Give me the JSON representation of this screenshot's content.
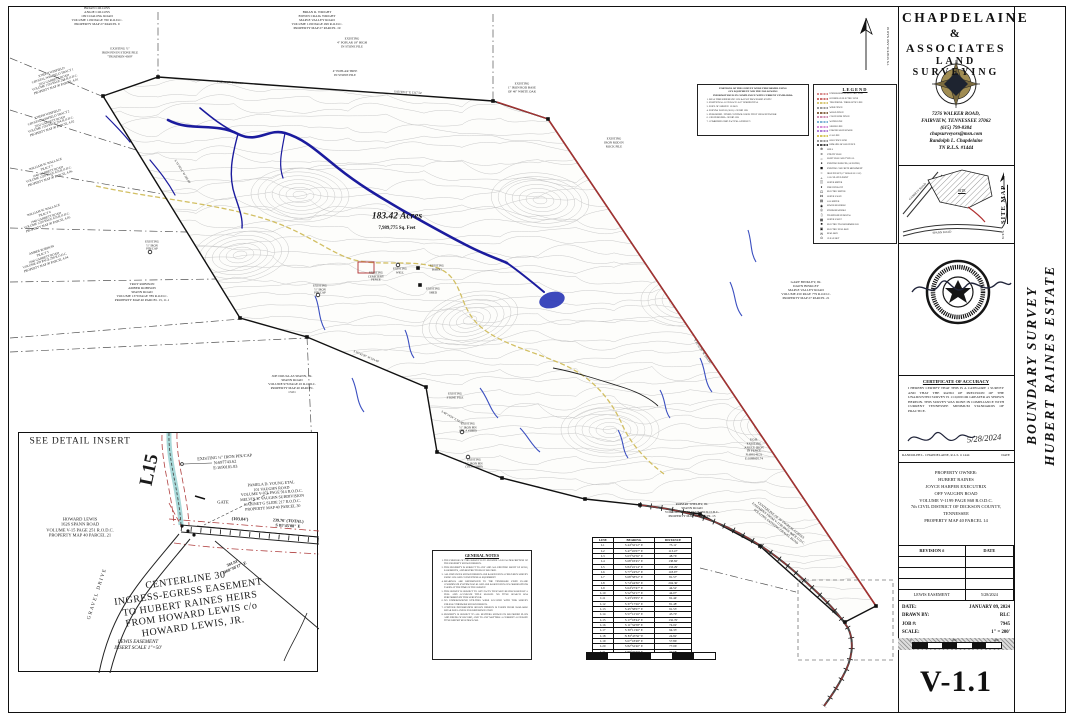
{
  "sheet": {
    "number": "V-1.1"
  },
  "title_block": {
    "line1": "CHAPDELAINE",
    "line2": "& ASSOCIATES",
    "line3": "LAND SURVEYING",
    "address1": "7276 WALKER ROAD,",
    "address2": "FAIRVIEW, TENNESSEE 37062",
    "phone": "(615) 799-8384",
    "email": "chapsurveyors@msn.com",
    "surveyor": "Randolph L. Chapdelaine",
    "license": "TN R.L.S. #1444"
  },
  "side_title": {
    "line1": "BOUNDARY SURVEY",
    "line2": "HUBERT RAINES ESTATE"
  },
  "site_map": {
    "label": "SITE MAP",
    "nts": "N.T.S.",
    "site": "SITE",
    "road1": "GARRETT ROAD",
    "road2": "SPANN ROAD"
  },
  "certificate": {
    "title": "CERTIFICATE OF ACCURACY",
    "body": "I HEREBY CERTIFY THAT THIS IS A CATEGORY 1 SURVEY AND THAT THE RATIO OF PRECISION OF THE UNADJUSTED SURVEY IS 1:10,000 OR GREATER AS SHOWN HEREON. THIS SURVEY WAS DONE IN COMPLIANCE WITH CURRENT TENNESSEE MINIMUM STANDARDS OF PRACTICE.",
    "sig_date": "5/28/2024",
    "signer": "RANDOLPH L. CHAPDELAINE, R.L.S. # 1444",
    "date_label": "DATE"
  },
  "owner_block": {
    "lines": [
      "PROPERTY OWNER:",
      "HUBERT RAINES",
      "JOYCE HARPER EXECUTRIX",
      "OFF VAUGHN ROAD",
      "VOLUME V-1199 PAGE 868 R.O.D.C.",
      "7th CIVIL DISTRICT OF DICKSON COUNTY,",
      "TENNESSEE",
      "PROPERTY MAP 40 PARCEL 14"
    ]
  },
  "revisions": {
    "header": {
      "rev": "REVISION #",
      "date": "DATE"
    },
    "rows": [
      [
        "",
        ""
      ],
      [
        "",
        ""
      ],
      [
        "",
        ""
      ],
      [
        "LEWIS EASEMENT",
        "5/28/2024"
      ]
    ]
  },
  "info_block": {
    "date_label": "DATE:",
    "date": "JANUARY 09, 2024",
    "drawn_label": "DRAWN BY:",
    "drawn": "RLC",
    "job_label": "JOB #:",
    "job": "7945",
    "scale_label": "SCALE:",
    "scale": "1\" = 200'",
    "bar_ticks": [
      "0",
      "200",
      "400"
    ]
  },
  "north": {
    "coord_note": "TN STATE PLANE  NAD 83"
  },
  "map": {
    "acreage": "183.42 Acres",
    "sqft": "7,989,775 Sq. Feet",
    "labels": [
      {
        "n": "owner-collins",
        "x": 97,
        "y": 16,
        "s": 3.4,
        "lines": [
          "BRIAN COLLINS",
          "ANGIE COLLINS",
          "199 COALING ROAD",
          "VOLUME 1199 PAGE 760 R.O.D.C.",
          "PROPERTY MAP 27 PARCEL 9"
        ]
      },
      {
        "n": "owner-wright",
        "x": 317,
        "y": 20,
        "s": 3.4,
        "lines": [
          "BRIAN R. WRIGHT",
          "EDWIN CRAIG WRIGHT",
          "MAPLE VALLEY ROAD",
          "VOLUME 1190 PAGE 499 R.O.D.C.",
          "PROPERTY MAP 27 PARCEL 19"
        ]
      },
      {
        "n": "pin-stone-pile",
        "x": 120,
        "y": 53,
        "s": 3.2,
        "lines": [
          "EXISTING ½\"",
          "IRON PIN IN STONE PILE",
          "\"TRIATHON 4309\""
        ]
      },
      {
        "n": "pin-poplar-18",
        "x": 352,
        "y": 43,
        "s": 3.2,
        "lines": [
          "EXISTING",
          "4\" POPLAR 18\" HIGH",
          "IN STONE PILE"
        ]
      },
      {
        "n": "pin-poplar",
        "x": 345,
        "y": 74,
        "s": 3.2,
        "lines": [
          "4\" POPLAR TREE",
          "IN STONE PILE"
        ]
      },
      {
        "n": "pin-white-oak",
        "x": 522,
        "y": 88,
        "s": 3.2,
        "lines": [
          "EXISTING",
          "1\" IRON ROD BASE",
          "OF 40\" WHITE OAK"
        ]
      },
      {
        "n": "pin-rock-pile",
        "x": 614,
        "y": 143,
        "s": 3.2,
        "lines": [
          "EXISTING",
          "IRON ROD IN",
          "ROCK PILE"
        ]
      },
      {
        "n": "owner-winfield-1",
        "x": 54,
        "y": 80,
        "s": 3.2,
        "r": -18,
        "lines": [
          "JOSEPH WINFIELD",
          "CRYSTAL WINFIELD TRACT 1",
          "2032 GARRETT ROAD",
          "VOLUME 1194 PAGE 264 R.O.D.C.",
          "PROPERTY MAP 40 PARCEL 4.01"
        ]
      },
      {
        "n": "owner-winfield-2",
        "x": 50,
        "y": 122,
        "s": 3.2,
        "r": -18,
        "lines": [
          "JOSEPH WINFIELD",
          "CRYSTAL WINFIELD TRACT 2",
          "2032 GARRETT ROAD",
          "VOLUME 1194 PAGE 264 R.O.D.C.",
          "PROPERTY MAP 40 PARCEL 4.02"
        ]
      },
      {
        "n": "owner-wallace-7",
        "x": 48,
        "y": 172,
        "s": 3.2,
        "r": -18,
        "lines": [
          "WILLIAM W. WALLACE",
          "TRACT 7",
          "1640 GARRETT ROAD",
          "VOLUME 1220 PAGE 679 R.O.D.C.",
          "PROPERTY MAP 40 PARCEL 4.06"
        ]
      },
      {
        "n": "owner-wallace-6",
        "x": 46,
        "y": 218,
        "s": 3.2,
        "r": -18,
        "lines": [
          "WILLIAM W. WALLACE",
          "TRACT 6",
          "1940 GARRETT ROAD",
          "VOLUME 1220 PAGE 679 R.O.D.C.",
          "PROPERTY MAP 40 PARCEL 4.05"
        ]
      },
      {
        "n": "owner-robison-5",
        "x": 44,
        "y": 258,
        "s": 3.2,
        "r": -18,
        "lines": [
          "AMBER ROBISON",
          "TRACT 5",
          "1660 GARRETT ROAD",
          "VOLUME 459 PAGE 298 R.O.D.C.",
          "PROPERTY MAP 40 PARCEL 4.04"
        ]
      },
      {
        "n": "owner-troy-robison",
        "x": 142,
        "y": 292,
        "s": 3.4,
        "lines": [
          "TROY ROBISON",
          "AMBER ROBISON",
          "SPANN ROAD",
          "VOLUME 1379 PAGE 789 R.O.D.C.",
          "PROPERTY MAP 40 PARCEL 13, 11.1"
        ]
      },
      {
        "n": "pin-cap-1",
        "x": 152,
        "y": 246,
        "s": 3,
        "lines": [
          "EXISTING",
          "½\" IRON",
          "PIN/CAP"
        ]
      },
      {
        "n": "pin-cap-2",
        "x": 320,
        "y": 290,
        "s": 3,
        "lines": [
          "EXISTING",
          "½\" IRON",
          "PIN/CAP"
        ]
      },
      {
        "n": "owner-spann",
        "x": 292,
        "y": 384,
        "s": 3.4,
        "lines": [
          "JOE DOUGLAS SPANN, JR.",
          "SPANN ROAD",
          "VOLUME 976 PAGE 45 R.O.D.C.",
          "PROPERTY MAP 40 PARCEL",
          "13.01"
        ]
      },
      {
        "n": "pin-stone-pile-2",
        "x": 455,
        "y": 396,
        "s": 3,
        "lines": [
          "EXISTING",
          "STONE PILE"
        ]
      },
      {
        "n": "pin-tila-1",
        "x": 468,
        "y": 428,
        "s": 3,
        "lines": [
          "EXISTING",
          "½\" IRON PIN",
          "(TILA #3889)"
        ]
      },
      {
        "n": "pin-tila-2",
        "x": 474,
        "y": 464,
        "s": 3,
        "lines": [
          "EXISTING",
          "½\" IRON PIN",
          "(TILA #3889)"
        ]
      },
      {
        "n": "owner-binkley",
        "x": 806,
        "y": 290,
        "s": 3.4,
        "lines": [
          "GARY BINKLEY, JR.",
          "DAWN BINKLEY",
          "MAPLE VALLEY ROAD",
          "VOLUME 450 PAGE 779 R.O.D.C.",
          "PROPERTY MAP 27 PARCEL 21"
        ]
      },
      {
        "n": "owner-shelby",
        "x": 692,
        "y": 510,
        "s": 3.4,
        "lines": [
          "ROBERT SHELBY, JR.",
          "SPANN ROAD",
          "VOLUME V-1132 PAGE 584 R.O.D.C.",
          "PROPERTY MAP 40 PARCEL 13"
        ]
      },
      {
        "n": "pob-label",
        "x": 754,
        "y": 450,
        "s": 3.2,
        "lines": [
          "P.O.B.",
          "EXISTING",
          "ANGLE IRON",
          "IN FENCE",
          "N:698146.21",
          "E:1689605.74"
        ]
      },
      {
        "n": "feat-cemetery",
        "x": 376,
        "y": 277,
        "s": 3,
        "lines": [
          "EXISTING",
          "CEMETERY",
          "FENCE"
        ]
      },
      {
        "n": "feat-well",
        "x": 400,
        "y": 271,
        "s": 3,
        "lines": [
          "EXISTING",
          "WELL"
        ]
      },
      {
        "n": "feat-barns",
        "x": 437,
        "y": 268,
        "s": 3,
        "lines": [
          "EXISTING",
          "BARNS"
        ]
      },
      {
        "n": "feat-shed",
        "x": 433,
        "y": 291,
        "s": 3,
        "lines": [
          "EXISTING",
          "SHED"
        ]
      },
      {
        "n": "easement-centerline",
        "x": 778,
        "y": 524,
        "s": 3.3,
        "r": 38,
        "lines": [
          "CENTERLINE OF 30' INGRESS-EGRESS",
          "EASEMENT FROM V-1199 PAGE 868 R.O.D.C.",
          "FOLLOWS EXISTING GRAVEL ROAD"
        ]
      },
      {
        "n": "edge-bearing-top1",
        "x": 230,
        "y": 83,
        "s": 3,
        "r": 4,
        "lines": [
          "S 86°41'37\" E   290.10'"
        ]
      },
      {
        "n": "edge-bearing-top2",
        "x": 408,
        "y": 93,
        "s": 3,
        "r": 3,
        "lines": [
          "S 85°58'12\" E   1317.54'"
        ]
      },
      {
        "n": "edge-bearing-left",
        "x": 182,
        "y": 172,
        "s": 3,
        "r": 58,
        "lines": [
          "S 31°06'14\" W   365.88'"
        ]
      },
      {
        "n": "edge-bearing-right",
        "x": 702,
        "y": 352,
        "s": 3,
        "r": 56,
        "lines": [
          "S 33°51'26\" W   1871.07'"
        ]
      },
      {
        "n": "edge-bearing-se",
        "x": 452,
        "y": 418,
        "s": 3,
        "r": 30,
        "lines": [
          "S 48°14'24\" E   94.37'"
        ]
      },
      {
        "n": "edge-bearing-sw",
        "x": 366,
        "y": 357,
        "s": 3,
        "r": 23,
        "lines": [
          "S 56°42'30\" W   324.49'"
        ]
      },
      {
        "n": "acreage-label",
        "x": 397,
        "y": 217,
        "s": 9.5,
        "b": 1,
        "i": 1,
        "lines": [
          "183.42 Acres"
        ]
      },
      {
        "n": "sqft-label",
        "x": 397,
        "y": 229,
        "s": 4.8,
        "b": 1,
        "lines": [
          "7,989,775 Sq. Feet"
        ]
      },
      {
        "n": "coord-note",
        "x": 889,
        "y": 46,
        "s": 3.3,
        "r": -90,
        "lines": [
          "TN STATE PLANE  NAD 83"
        ]
      },
      {
        "n": "insert-title",
        "x": 80,
        "y": 442,
        "s": 9.5,
        "ls": 0.8,
        "lines": [
          "SEE DETAIL INSERT"
        ]
      },
      {
        "n": "insert-l15",
        "x": 150,
        "y": 470,
        "s": 19,
        "b": 1,
        "r": -78,
        "lines": [
          "L15"
        ]
      },
      {
        "n": "insert-pin-cap",
        "x": 225,
        "y": 462,
        "s": 4.3,
        "r": -4,
        "lines": [
          "EXISTING ½\" IRON PIN/CAP",
          "N:697743.62",
          "E:1690181.83"
        ]
      },
      {
        "n": "insert-owner-young",
        "x": 272,
        "y": 496,
        "s": 4,
        "r": -4,
        "lines": [
          "PAMELA D. YOUNG ETAL",
          "101 VAUGHN ROAD",
          "VOLUME V-871 PAGE 914 R.O.D.C.",
          "MELVIN E. VAUGHN SUBDIVISION",
          "CABINET G SLIDE 217 R.O.D.C.",
          "PROPERTY MAP 40 PARCEL 30"
        ]
      },
      {
        "n": "insert-gate",
        "x": 223,
        "y": 502,
        "s": 4.5,
        "lines": [
          "GATE"
        ]
      },
      {
        "n": "insert-owner-lewis",
        "x": 80,
        "y": 527,
        "s": 4.5,
        "lines": [
          "HOWARD LEWIS",
          "1626 SPANN ROAD",
          "VOLUME V-15 PAGE 251 R.O.D.C.",
          "PROPERTY MAP 40 PARCEL 21"
        ]
      },
      {
        "n": "insert-dim-1",
        "x": 240,
        "y": 519,
        "s": 4.5,
        "r": 3,
        "b": 1,
        "lines": [
          "(103.84')"
        ]
      },
      {
        "n": "insert-dim-2",
        "x": 288,
        "y": 524,
        "s": 4.2,
        "r": 3,
        "b": 1,
        "lines": [
          "239.76' (TOTAL)",
          "S 81°45'08\" E"
        ]
      },
      {
        "n": "insert-dim-3",
        "x": 234,
        "y": 566,
        "s": 4.2,
        "r": -24,
        "b": 1,
        "lines": [
          "301.91'",
          "S 60°30'17\" E"
        ]
      },
      {
        "n": "insert-easement-text",
        "x": 190,
        "y": 604,
        "s": 10,
        "r": -8,
        "ls": 0.5,
        "lines": [
          "CENTERLINE 30'",
          "INGRESS-EGRESS  EASEMENT",
          "TO HUBERT RAINES HEIRS",
          "FROM HOWARD LEWIS c/o",
          "HOWARD LEWIS, JR."
        ]
      },
      {
        "n": "insert-gravel-drive",
        "x": 98,
        "y": 594,
        "s": 5,
        "r": -72,
        "ls": 1.5,
        "lines": [
          "GRAVEL DRIVE"
        ]
      },
      {
        "n": "insert-caption",
        "x": 138,
        "y": 646,
        "s": 5,
        "i": 1,
        "lines": [
          "LEWIS EASEMENT",
          "INSERT SCALE 1\"=50'"
        ]
      }
    ]
  },
  "gps_notes": {
    "header": [
      "PORTIONS OF THIS SURVEY WERE PERFORMED USING",
      "GPS EQUIPMENT AND THE FOLLOWING",
      "INFORMATION IS IN COMPLIANCE WITH CURRENT STANDARDS:"
    ],
    "items": [
      "REAL TIME KINEMATIC GPS & POST PROCESSED STATIC",
      "POSITIONAL ACCURACY: 0.07' HORIZONTAL",
      "DATE OF SURVEY: 12/2023",
      "DATUM: NAD 83 (2011) / GEOID 12B",
      "PUBLISHED / FIXED CONTROL USED: TDOT GNSS NETWORK",
      "GEOID MODEL: GEOID 12B",
      "COMBINED GRID FACTOR: 0.99995271"
    ]
  },
  "legend": {
    "title": "LEGEND",
    "entries": [
      {
        "type": "line",
        "color": "#d98c8c",
        "label": "UNDERGROUND ELECTRIC LINE"
      },
      {
        "type": "line",
        "color": "#cc7070",
        "label": "OVERHEAD ELECTRIC LINE"
      },
      {
        "type": "line",
        "color": "#d8c878",
        "label": "TELEPHONE / FIBER OPTIC LINE"
      },
      {
        "type": "line",
        "color": "#9a9a9a",
        "label": "WIRE FENCE"
      },
      {
        "type": "line",
        "color": "#8a6a4a",
        "label": "WOOD FENCE"
      },
      {
        "type": "line",
        "color": "#cf8fb0",
        "label": "CHAIN LINK FENCE"
      },
      {
        "type": "line",
        "color": "#7fb3d5",
        "label": "WATER LINE"
      },
      {
        "type": "line",
        "color": "#d78fd7",
        "label": "SEWER LINE"
      },
      {
        "type": "line",
        "color": "#b07fd7",
        "label": "FORCED MAIN SEWER"
      },
      {
        "type": "line",
        "color": "#d7c75f",
        "label": "GAS LINE"
      },
      {
        "type": "line",
        "color": "#9a9a9a",
        "label": "OLD FENCE LINE"
      },
      {
        "type": "line",
        "color": "#4a4a4a",
        "label": "REMAINS OF OLD FENCE"
      },
      {
        "type": "sym",
        "glyph": "⊕",
        "label": "WELL"
      },
      {
        "type": "sym",
        "glyph": "⨯",
        "label": "UTILITY POLE"
      },
      {
        "type": "sym",
        "glyph": "☼",
        "label": "LIGHT POLE AND TYPICAL"
      },
      {
        "type": "sym",
        "glyph": "●",
        "label": "EXISTING IRON PIN (AS NOTED)"
      },
      {
        "type": "sym",
        "glyph": "◼",
        "label": "EXISTING CONCRETE MONUMENT"
      },
      {
        "type": "sym",
        "glyph": "○",
        "label": "IRON PIN SET (½\" REBAR W/ CAP)"
      },
      {
        "type": "sym",
        "glyph": "▵",
        "label": "CALCULATED POINT"
      },
      {
        "type": "sym",
        "glyph": "◫",
        "label": "WATER METER"
      },
      {
        "type": "sym",
        "glyph": "♦",
        "label": "FIRE HYDRANT"
      },
      {
        "type": "sym",
        "glyph": "⊡",
        "label": "ELECTRIC METER"
      },
      {
        "type": "sym",
        "glyph": "⋈",
        "label": "WATER VALVE"
      },
      {
        "type": "sym",
        "glyph": "▤",
        "label": "GAS METER"
      },
      {
        "type": "sym",
        "glyph": "◉",
        "label": "SEWER MANHOLE"
      },
      {
        "type": "sym",
        "glyph": "◎",
        "label": "STORM MANHOLE"
      },
      {
        "type": "sym",
        "glyph": "▯",
        "label": "TELEPHONE PEDESTAL"
      },
      {
        "type": "sym",
        "glyph": "▦",
        "label": "WATER VAULT"
      },
      {
        "type": "sym",
        "glyph": "■",
        "label": "ELECTRIC TRANSFORMER PAD"
      },
      {
        "type": "sym",
        "glyph": "▣",
        "label": "ELECTRIC PULL BOX"
      },
      {
        "type": "sym",
        "glyph": "✉",
        "label": "MAIL BOX"
      },
      {
        "type": "sym",
        "glyph": "⊙",
        "label": "CLEAN OUT"
      }
    ]
  },
  "general_notes": {
    "title": "GENERAL NOTES",
    "items": [
      "THE PURPOSE OF THIS SURVEY IS TO PROVIDE A LEGAL DESCRIPTION OF THE PROPERTY SHOWN HEREON.",
      "THIS PROPERTY IS SUBJECT TO ANY AND ALL EXISTING RIGHT OF WAYS, EASEMENTS, AND RESTRICTIONS OF RECORD.",
      "ALL DISTANCES SHOWN HEREON ARE BASED UPON A FIELD RUN SURVEY USING GPS AND CONVENTIONAL EQUIPMENT.",
      "BEARINGS ARE REFERENCED TO THE TENNESSEE STATE PLANE COORDINATE SYSTEM NAD 83 AND ARE BASED UPON GPS OBSERVATIONS TAKEN AT THE TIME OF THE SURVEY.",
      "THIS SURVEY IS SUBJECT TO ANY FACTS THAT MAY BE DISCLOSED BY A FULL AND ACCURATE TITLE SEARCH. NO TITLE SEARCH WAS PERFORMED BY THIS SURVEYOR.",
      "NO UNDERGROUND UTILITIES WERE LOCATED WITH THIS SURVEY UNLESS OTHERWISE SHOWN HEREON.",
      "CONTOUR INFORMATION SHOWN HEREON IS TAKEN FROM AVAILABLE LIDAR DATA AND IS FOR REFERENCE ONLY.",
      "PROPERTY IS SUBJECT TO ALL MATTERS SHOWN ON RECORDED PLATS AND DEEDS OF RECORD, AND TO ANY MATTERS A CURRENT ACCURATE TITLE REPORT MAY DISCLOSE."
    ]
  },
  "line_table": {
    "headers": [
      "LINE",
      "BEARING",
      "DISTANCE"
    ],
    "rows": [
      [
        "L1",
        "S 44°32'12\" E",
        "73.11'"
      ],
      [
        "L2",
        "S 47°45'07\" E",
        "113.47'"
      ],
      [
        "L3",
        "S 63°52'56\" E",
        "48.76'"
      ],
      [
        "L4",
        "S 68°03'45\" E",
        "138.82'"
      ],
      [
        "L5",
        "S 84°22'14\" E",
        "133.29'"
      ],
      [
        "L6",
        "S 77°24'52\" E",
        "118.97'"
      ],
      [
        "L7",
        "S 68°58'52\" E",
        "81.57'"
      ],
      [
        "L8",
        "S 74°44'30\" E",
        "204.36'"
      ],
      [
        "L9",
        "S 64°27'47\" E",
        "44.52'"
      ],
      [
        "L10",
        "S 52°52'17\" E",
        "44.07'"
      ],
      [
        "L11",
        "S 43°23'05\" E",
        "91.44'"
      ],
      [
        "L12",
        "S 37°17'26\" E",
        "81.48'"
      ],
      [
        "L13",
        "S 45°58'07\" E",
        "91.53'"
      ],
      [
        "L14",
        "S 57°12'16\" E",
        "43.70'"
      ],
      [
        "L15",
        "S 17°18'44\" E",
        "132.76'"
      ],
      [
        "L16",
        "S 11°34'58\" E",
        "74.02'"
      ],
      [
        "L17",
        "S 30°11'46\" E",
        "94.33'"
      ],
      [
        "L18",
        "N 83°43'56\" E",
        "24.82'"
      ],
      [
        "L19",
        "S 67°18'48\" E",
        "57.86'"
      ],
      [
        "L20",
        "S 82°52'40\" E",
        "77.06'"
      ],
      [
        "L21",
        "S 89°46'40\" E",
        "37.68'"
      ]
    ]
  }
}
